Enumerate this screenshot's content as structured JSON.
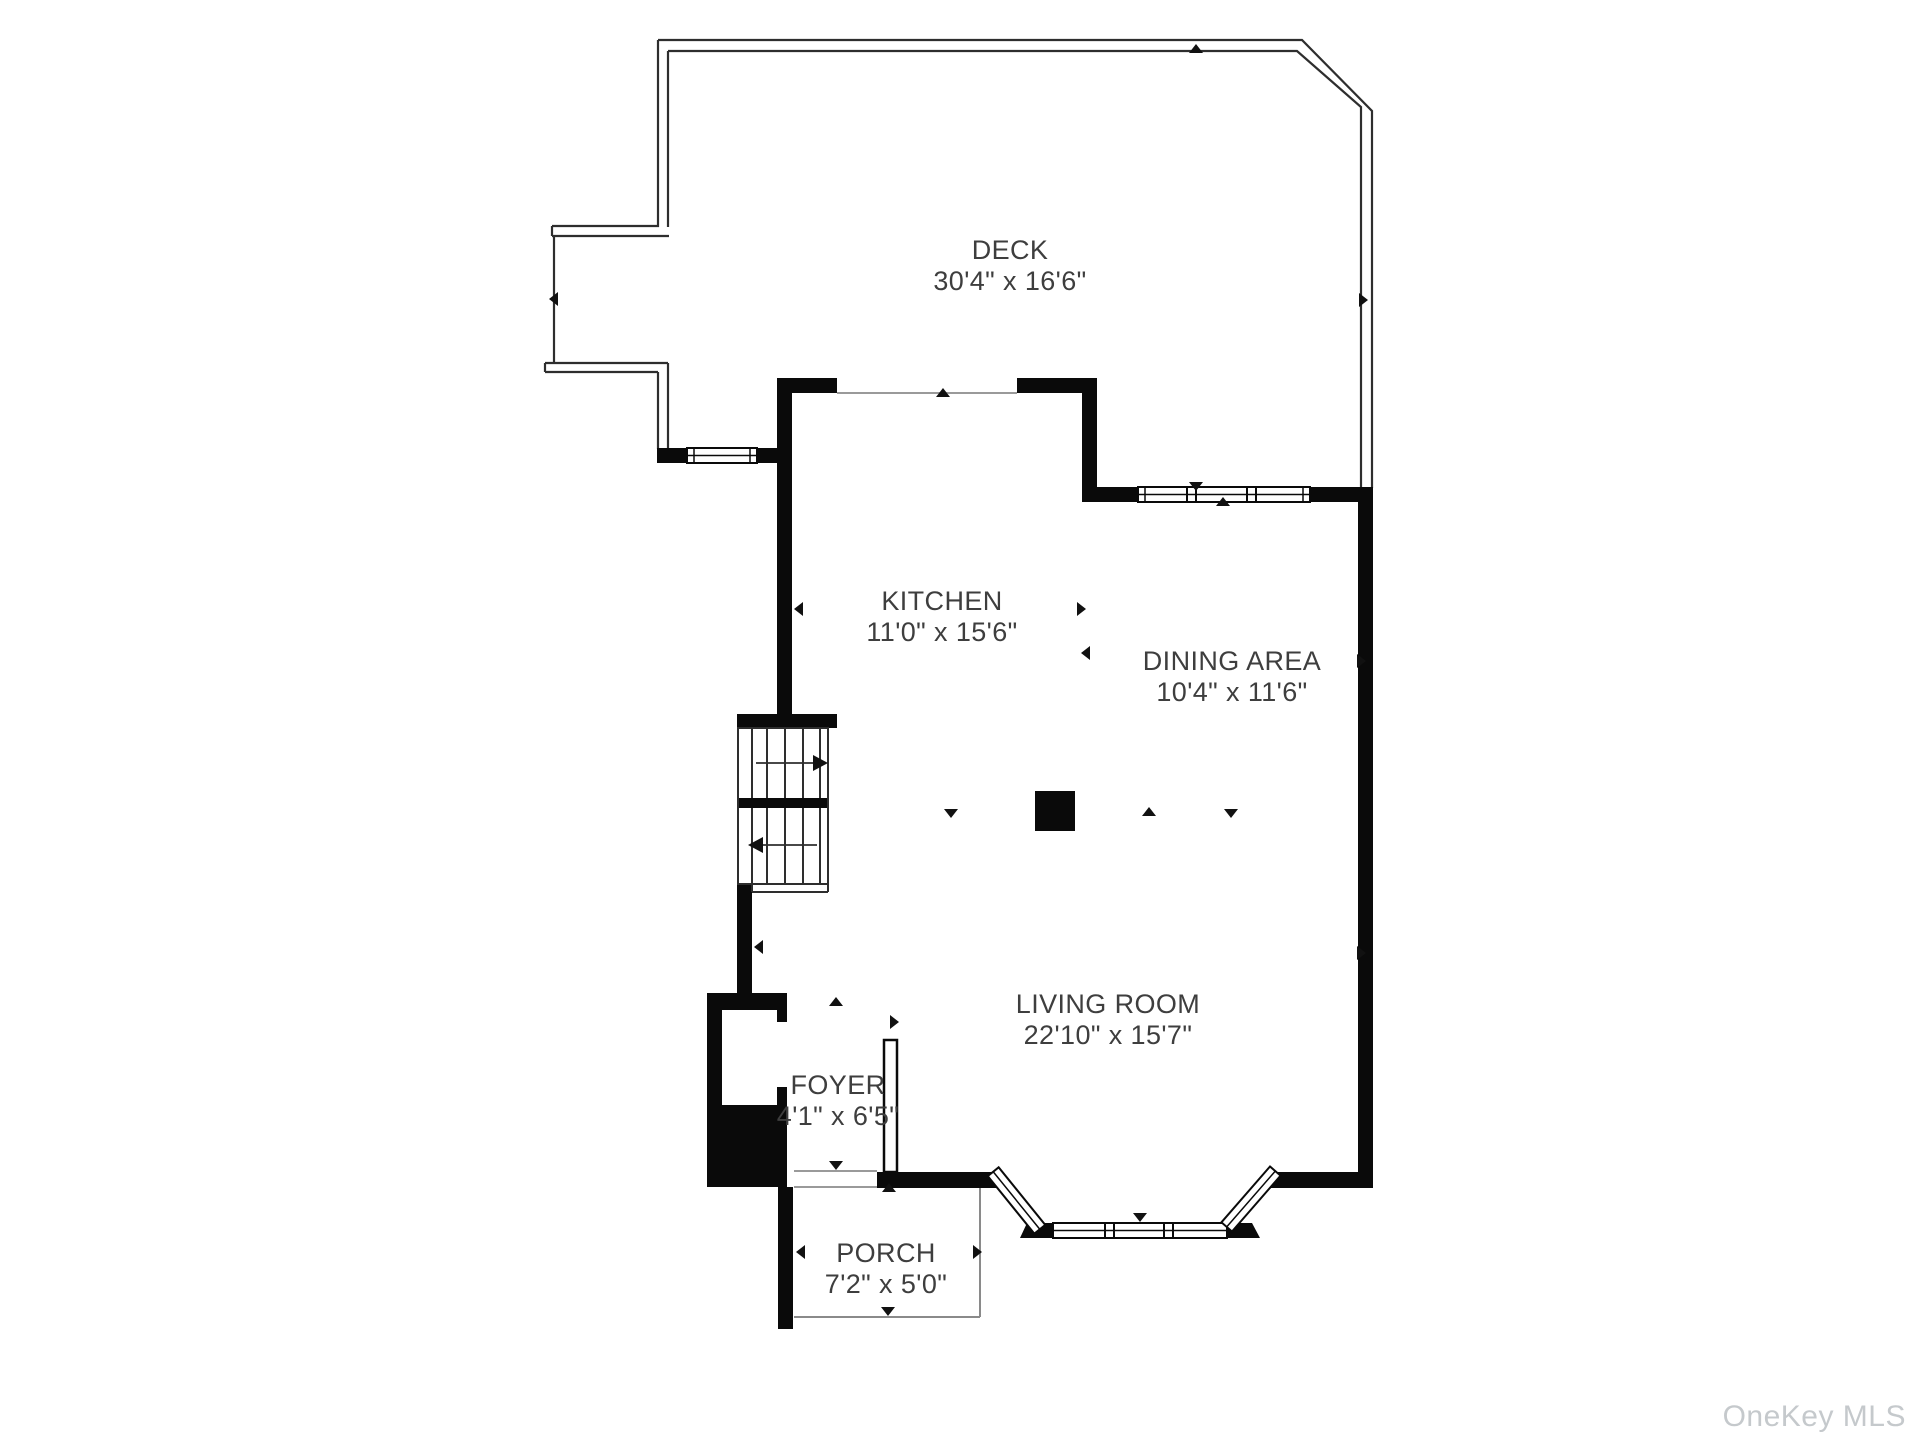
{
  "watermark": "OneKey MLS",
  "colors": {
    "wall": "#0a0a0a",
    "deck_line": "#2e2e2e",
    "opening_line": "#9a9a9a",
    "text": "#3e3e3e",
    "watermark": "#c5c9cc",
    "background": "#ffffff"
  },
  "icons": {
    "direction_marker": "small black triangle",
    "stair_direction": "line with arrowhead"
  },
  "rooms": [
    {
      "name": "DECK",
      "dims": "30'4\" x 16'6\"",
      "cx": 1010,
      "cy": 266
    },
    {
      "name": "KITCHEN",
      "dims": "11'0\" x 15'6\"",
      "cx": 942,
      "cy": 617
    },
    {
      "name": "DINING AREA",
      "dims": "10'4\" x 11'6\"",
      "cx": 1232,
      "cy": 677
    },
    {
      "name": "LIVING ROOM",
      "dims": "22'10\" x 15'7\"",
      "cx": 1108,
      "cy": 1020
    },
    {
      "name": "FOYER",
      "dims": "4'1\" x 6'5\"",
      "cx": 838,
      "cy": 1101
    },
    {
      "name": "PORCH",
      "dims": "7'2\" x 5'0\"",
      "cx": 886,
      "cy": 1269
    }
  ]
}
